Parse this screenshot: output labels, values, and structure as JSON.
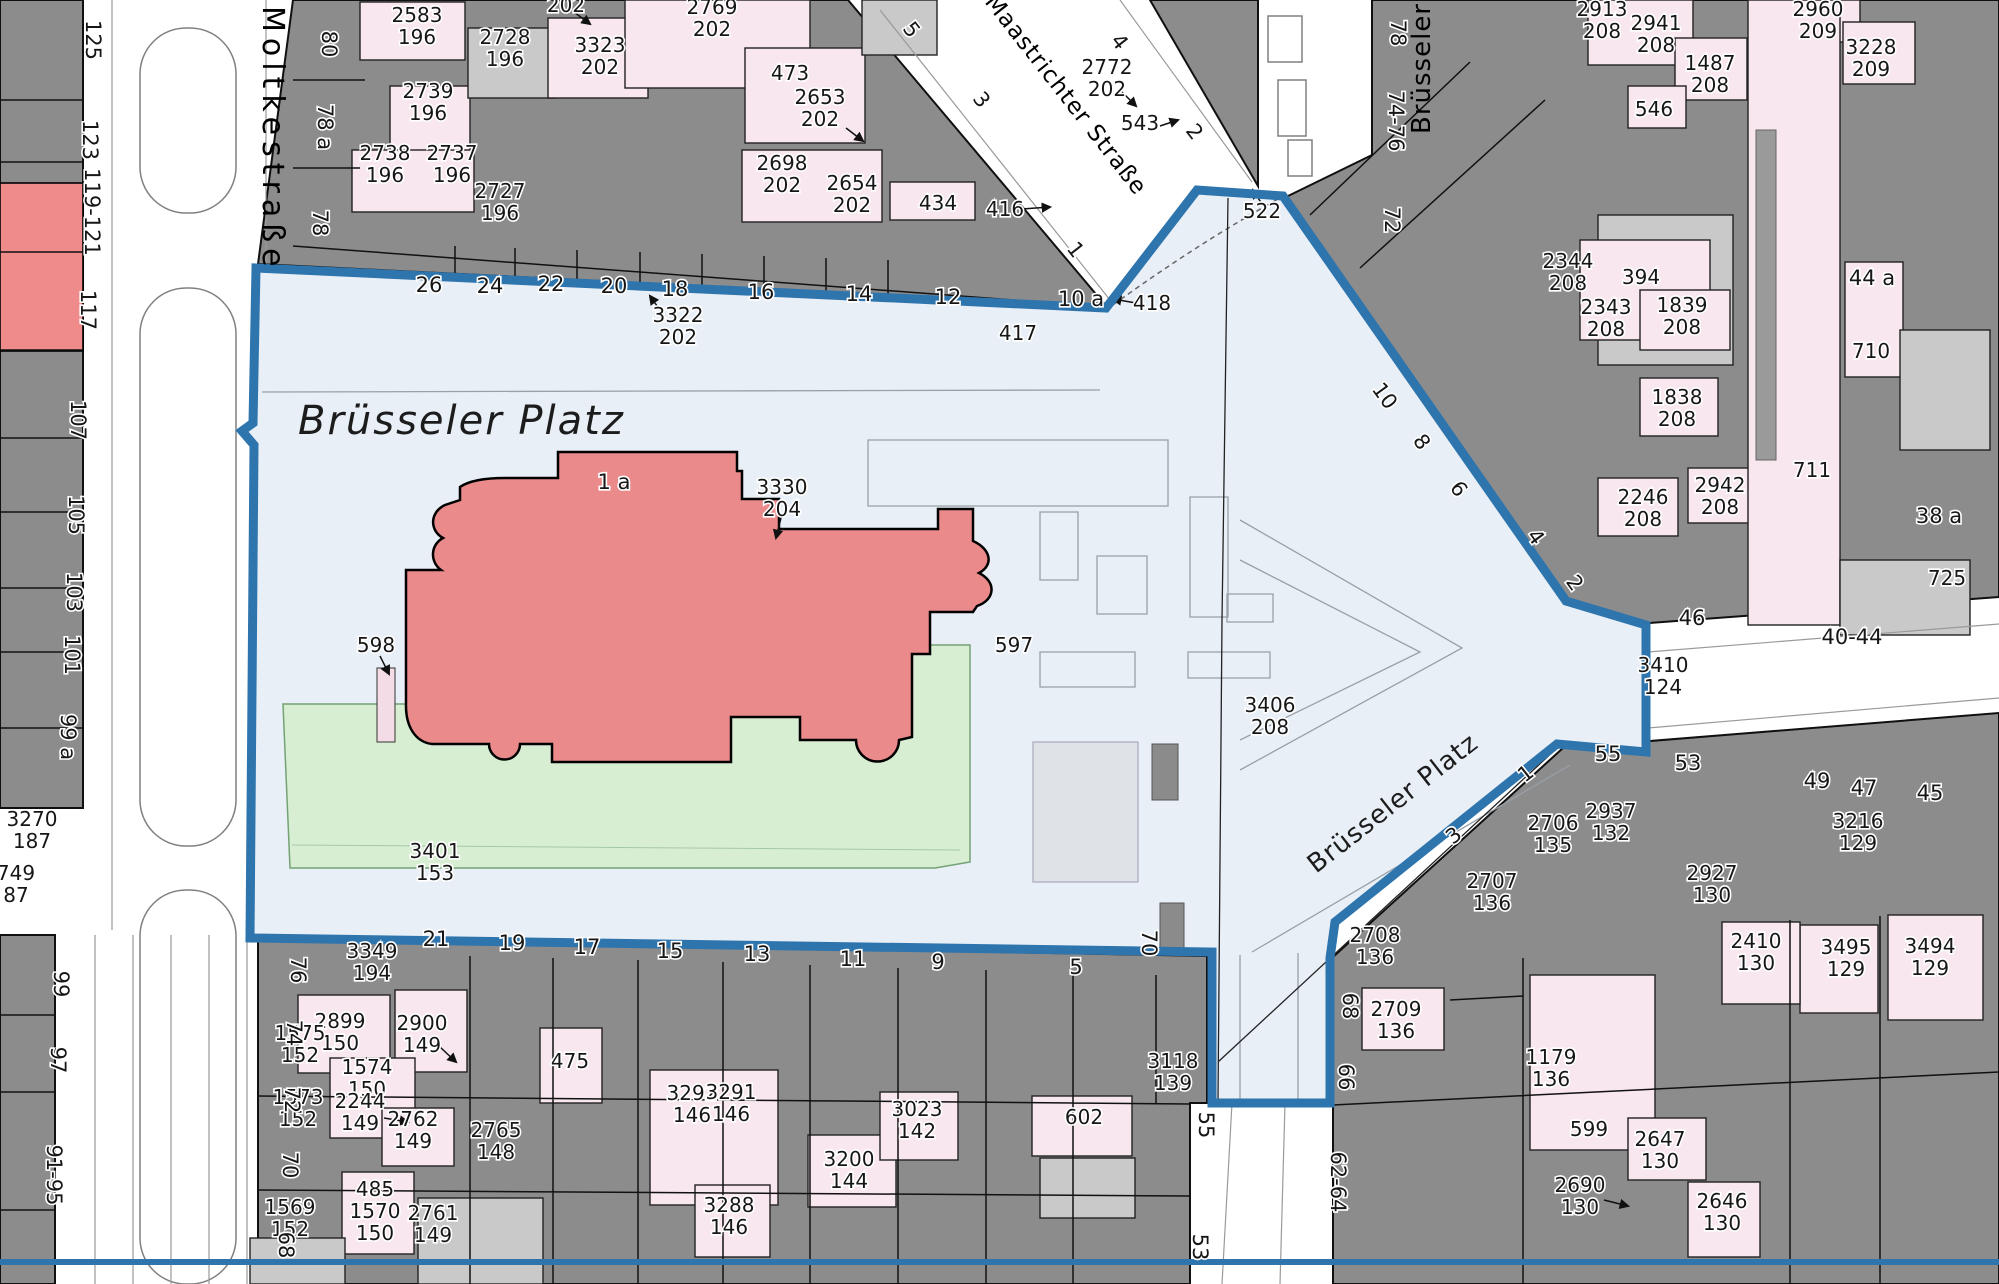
{
  "map": {
    "title": "Brüsseler Platz",
    "colors": {
      "boundary_blue": "#2e74ad",
      "plaza_fill": "#e9eff6",
      "building_gray": "#8c8c8c",
      "parcel_pink": "#f8e7ef",
      "courtyard_gray": "#c9c9c9",
      "red_parcel": "#f08b8b",
      "church_red": "#ea8a8a",
      "lawn_green": "#d8eed3"
    },
    "labels": [
      {
        "t": [
          "Moltkestraße"
        ],
        "x": 263,
        "y": 6,
        "r": 90,
        "c": "s2"
      },
      {
        "t": [
          "Maastrichter Straße"
        ],
        "x": 984,
        "y": 2,
        "r": 52,
        "c": "s3"
      },
      {
        "t": [
          "Brüsseler S"
        ],
        "x": 1430,
        "y": 134,
        "r": -90,
        "c": "s"
      },
      {
        "t": [
          "Brüsseler Platz"
        ],
        "x": 298,
        "y": 434,
        "c": "b"
      },
      {
        "t": [
          "Brüsseler Platz"
        ],
        "x": 1316,
        "y": 874,
        "r": -38,
        "c": "d"
      },
      {
        "t": [
          "1 a"
        ],
        "x": 614,
        "y": 489,
        "c": "h"
      },
      {
        "t": [
          "2583",
          "196"
        ],
        "x": 417,
        "y": 22,
        "c": "p"
      },
      {
        "t": [
          "2739",
          "196"
        ],
        "x": 428,
        "y": 98,
        "c": "p"
      },
      {
        "t": [
          "2738",
          "196"
        ],
        "x": 385,
        "y": 160,
        "c": "p"
      },
      {
        "t": [
          "2737",
          "196"
        ],
        "x": 452,
        "y": 160,
        "c": "p"
      },
      {
        "t": [
          "2727",
          "196"
        ],
        "x": 500,
        "y": 198,
        "c": "p"
      },
      {
        "t": [
          "2728",
          "196"
        ],
        "x": 505,
        "y": 44,
        "c": "p"
      },
      {
        "t": [
          "3323",
          "202"
        ],
        "x": 600,
        "y": 52,
        "c": "p"
      },
      {
        "t": [
          "2769",
          "202"
        ],
        "x": 712,
        "y": 14,
        "c": "p"
      },
      {
        "t": [
          "202"
        ],
        "x": 566,
        "y": 12,
        "c": "p"
      },
      {
        "t": [
          "473"
        ],
        "x": 790,
        "y": 80,
        "c": "p"
      },
      {
        "t": [
          "2653",
          "202"
        ],
        "x": 820,
        "y": 104,
        "c": "p"
      },
      {
        "t": [
          "2698",
          "202"
        ],
        "x": 782,
        "y": 170,
        "c": "p"
      },
      {
        "t": [
          "2654",
          "202"
        ],
        "x": 852,
        "y": 190,
        "c": "p"
      },
      {
        "t": [
          "434"
        ],
        "x": 938,
        "y": 210,
        "c": "p"
      },
      {
        "t": [
          "416"
        ],
        "x": 1005,
        "y": 216,
        "c": "p"
      },
      {
        "t": [
          "2772",
          "202"
        ],
        "x": 1107,
        "y": 74,
        "c": "p"
      },
      {
        "t": [
          "543"
        ],
        "x": 1140,
        "y": 130,
        "c": "p"
      },
      {
        "t": [
          "417"
        ],
        "x": 1018,
        "y": 340,
        "c": "p"
      },
      {
        "t": [
          "418"
        ],
        "x": 1152,
        "y": 310,
        "c": "p"
      },
      {
        "t": [
          "522"
        ],
        "x": 1262,
        "y": 218,
        "c": "p"
      },
      {
        "t": [
          "3322",
          "202"
        ],
        "x": 678,
        "y": 322,
        "c": "p"
      },
      {
        "t": [
          "3330",
          "204"
        ],
        "x": 782,
        "y": 494,
        "c": "p"
      },
      {
        "t": [
          "597"
        ],
        "x": 1014,
        "y": 652,
        "c": "p"
      },
      {
        "t": [
          "598"
        ],
        "x": 376,
        "y": 652,
        "c": "p"
      },
      {
        "t": [
          "3406",
          "208"
        ],
        "x": 1270,
        "y": 712,
        "c": "p"
      },
      {
        "t": [
          "3401",
          "153"
        ],
        "x": 435,
        "y": 858,
        "c": "p"
      },
      {
        "t": [
          "3270",
          "187"
        ],
        "x": 32,
        "y": 826,
        "c": "p"
      },
      {
        "t": [
          "749",
          "87"
        ],
        "x": 16,
        "y": 880,
        "c": "p"
      },
      {
        "t": [
          "3410",
          "124"
        ],
        "x": 1663,
        "y": 672,
        "c": "p"
      },
      {
        "t": [
          "2913",
          "208"
        ],
        "x": 1602,
        "y": 16,
        "c": "p"
      },
      {
        "t": [
          "2941",
          "208"
        ],
        "x": 1656,
        "y": 30,
        "c": "p"
      },
      {
        "t": [
          "1487",
          "208"
        ],
        "x": 1710,
        "y": 70,
        "c": "p"
      },
      {
        "t": [
          "2960",
          "209"
        ],
        "x": 1818,
        "y": 16,
        "c": "p"
      },
      {
        "t": [
          "3228",
          "209"
        ],
        "x": 1871,
        "y": 54,
        "c": "p"
      },
      {
        "t": [
          "546"
        ],
        "x": 1654,
        "y": 116,
        "c": "p"
      },
      {
        "t": [
          "2344",
          "208"
        ],
        "x": 1568,
        "y": 268,
        "c": "p"
      },
      {
        "t": [
          "394"
        ],
        "x": 1641,
        "y": 284,
        "c": "p"
      },
      {
        "t": [
          "2343",
          "208"
        ],
        "x": 1606,
        "y": 314,
        "c": "p"
      },
      {
        "t": [
          "1839",
          "208"
        ],
        "x": 1682,
        "y": 312,
        "c": "p"
      },
      {
        "t": [
          "1838",
          "208"
        ],
        "x": 1677,
        "y": 404,
        "c": "p"
      },
      {
        "t": [
          "2246",
          "208"
        ],
        "x": 1643,
        "y": 504,
        "c": "p"
      },
      {
        "t": [
          "2942",
          "208"
        ],
        "x": 1720,
        "y": 492,
        "c": "p"
      },
      {
        "t": [
          "710"
        ],
        "x": 1871,
        "y": 358,
        "c": "p"
      },
      {
        "t": [
          "711"
        ],
        "x": 1812,
        "y": 477,
        "c": "p"
      },
      {
        "t": [
          "725"
        ],
        "x": 1947,
        "y": 585,
        "c": "p"
      },
      {
        "t": [
          "2706",
          "135"
        ],
        "x": 1553,
        "y": 830,
        "c": "p"
      },
      {
        "t": [
          "2707",
          "136"
        ],
        "x": 1492,
        "y": 888,
        "c": "p"
      },
      {
        "t": [
          "2708",
          "136"
        ],
        "x": 1375,
        "y": 942,
        "c": "p"
      },
      {
        "t": [
          "2709",
          "136"
        ],
        "x": 1396,
        "y": 1016,
        "c": "p"
      },
      {
        "t": [
          "2937",
          "132"
        ],
        "x": 1611,
        "y": 818,
        "c": "p"
      },
      {
        "t": [
          "3216",
          "129"
        ],
        "x": 1858,
        "y": 828,
        "c": "p"
      },
      {
        "t": [
          "2927",
          "130"
        ],
        "x": 1712,
        "y": 880,
        "c": "p"
      },
      {
        "t": [
          "2410",
          "130"
        ],
        "x": 1756,
        "y": 948,
        "c": "p"
      },
      {
        "t": [
          "3495",
          "129"
        ],
        "x": 1846,
        "y": 954,
        "c": "p"
      },
      {
        "t": [
          "3494",
          "129"
        ],
        "x": 1930,
        "y": 953,
        "c": "p"
      },
      {
        "t": [
          "1179",
          "136"
        ],
        "x": 1551,
        "y": 1064,
        "c": "p"
      },
      {
        "t": [
          "599"
        ],
        "x": 1589,
        "y": 1136,
        "c": "p"
      },
      {
        "t": [
          "2647",
          "130"
        ],
        "x": 1660,
        "y": 1146,
        "c": "p"
      },
      {
        "t": [
          "2690",
          "130"
        ],
        "x": 1580,
        "y": 1192,
        "c": "p"
      },
      {
        "t": [
          "2646",
          "130"
        ],
        "x": 1722,
        "y": 1208,
        "c": "p"
      },
      {
        "t": [
          "3349",
          "194"
        ],
        "x": 372,
        "y": 958,
        "c": "p"
      },
      {
        "t": [
          "2899",
          "150"
        ],
        "x": 340,
        "y": 1028,
        "c": "p"
      },
      {
        "t": [
          "1575",
          "152"
        ],
        "x": 300,
        "y": 1040,
        "c": "p"
      },
      {
        "t": [
          "2900",
          "149"
        ],
        "x": 422,
        "y": 1030,
        "c": "p"
      },
      {
        "t": [
          "1574",
          "150"
        ],
        "x": 367,
        "y": 1074,
        "c": "p"
      },
      {
        "t": [
          "1573",
          "152"
        ],
        "x": 298,
        "y": 1104,
        "c": "p"
      },
      {
        "t": [
          "2244",
          "149"
        ],
        "x": 360,
        "y": 1108,
        "c": "p"
      },
      {
        "t": [
          "2762",
          "149"
        ],
        "x": 413,
        "y": 1126,
        "c": "p"
      },
      {
        "t": [
          "485"
        ],
        "x": 375,
        "y": 1196,
        "c": "p"
      },
      {
        "t": [
          "1570",
          "150"
        ],
        "x": 375,
        "y": 1218,
        "c": "p"
      },
      {
        "t": [
          "1569",
          "152"
        ],
        "x": 290,
        "y": 1214,
        "c": "p"
      },
      {
        "t": [
          "2761",
          "149"
        ],
        "x": 433,
        "y": 1220,
        "c": "p"
      },
      {
        "t": [
          "2765",
          "148"
        ],
        "x": 496,
        "y": 1137,
        "c": "p"
      },
      {
        "t": [
          "475"
        ],
        "x": 570,
        "y": 1068,
        "c": "p"
      },
      {
        "t": [
          "3292",
          "146"
        ],
        "x": 692,
        "y": 1100,
        "c": "p"
      },
      {
        "t": [
          "3291",
          "146"
        ],
        "x": 731,
        "y": 1099,
        "c": "p"
      },
      {
        "t": [
          "3288",
          "146"
        ],
        "x": 729,
        "y": 1212,
        "c": "p"
      },
      {
        "t": [
          "3200",
          "144"
        ],
        "x": 849,
        "y": 1166,
        "c": "p"
      },
      {
        "t": [
          "3023",
          "142"
        ],
        "x": 917,
        "y": 1116,
        "c": "p"
      },
      {
        "t": [
          "602"
        ],
        "x": 1084,
        "y": 1124,
        "c": "p"
      },
      {
        "t": [
          "3118",
          "139"
        ],
        "x": 1173,
        "y": 1068,
        "c": "p"
      },
      {
        "t": [
          "125"
        ],
        "x": 86,
        "y": 40,
        "r": 90,
        "c": "h"
      },
      {
        "t": [
          "123"
        ],
        "x": 83,
        "y": 140,
        "r": 90,
        "c": "h"
      },
      {
        "t": [
          "119-121"
        ],
        "x": 85,
        "y": 212,
        "r": 90,
        "c": "h"
      },
      {
        "t": [
          "117"
        ],
        "x": 81,
        "y": 310,
        "r": 90,
        "c": "h"
      },
      {
        "t": [
          "107"
        ],
        "x": 71,
        "y": 420,
        "r": 90,
        "c": "h"
      },
      {
        "t": [
          "105"
        ],
        "x": 69,
        "y": 515,
        "r": 90,
        "c": "h"
      },
      {
        "t": [
          "103"
        ],
        "x": 67,
        "y": 592,
        "r": 90,
        "c": "h"
      },
      {
        "t": [
          "101"
        ],
        "x": 65,
        "y": 655,
        "r": 90,
        "c": "h"
      },
      {
        "t": [
          "99 a"
        ],
        "x": 61,
        "y": 737,
        "r": 90,
        "c": "h"
      },
      {
        "t": [
          "99"
        ],
        "x": 54,
        "y": 984,
        "r": 90,
        "c": "h"
      },
      {
        "t": [
          "97"
        ],
        "x": 51,
        "y": 1060,
        "r": 90,
        "c": "h"
      },
      {
        "t": [
          "91-95"
        ],
        "x": 47,
        "y": 1175,
        "r": 90,
        "c": "h"
      },
      {
        "t": [
          "80"
        ],
        "x": 322,
        "y": 44,
        "r": 90,
        "c": "h"
      },
      {
        "t": [
          "78 a"
        ],
        "x": 318,
        "y": 127,
        "r": 90,
        "c": "h"
      },
      {
        "t": [
          "78"
        ],
        "x": 313,
        "y": 223,
        "r": 90,
        "c": "h"
      },
      {
        "t": [
          "76"
        ],
        "x": 291,
        "y": 970,
        "r": 90,
        "c": "h"
      },
      {
        "t": [
          "74"
        ],
        "x": 287,
        "y": 1033,
        "r": 90,
        "c": "h"
      },
      {
        "t": [
          "72"
        ],
        "x": 285,
        "y": 1100,
        "r": 90,
        "c": "h"
      },
      {
        "t": [
          "70"
        ],
        "x": 283,
        "y": 1165,
        "r": 90,
        "c": "h"
      },
      {
        "t": [
          "68"
        ],
        "x": 279,
        "y": 1245,
        "r": 90,
        "c": "h"
      },
      {
        "t": [
          "26"
        ],
        "x": 429,
        "y": 292,
        "c": "h"
      },
      {
        "t": [
          "24"
        ],
        "x": 490,
        "y": 293,
        "c": "h"
      },
      {
        "t": [
          "22"
        ],
        "x": 551,
        "y": 291,
        "c": "h"
      },
      {
        "t": [
          "20"
        ],
        "x": 614,
        "y": 293,
        "c": "h"
      },
      {
        "t": [
          "18"
        ],
        "x": 675,
        "y": 296,
        "c": "h"
      },
      {
        "t": [
          "16"
        ],
        "x": 761,
        "y": 299,
        "c": "h"
      },
      {
        "t": [
          "14"
        ],
        "x": 859,
        "y": 301,
        "c": "h"
      },
      {
        "t": [
          "12"
        ],
        "x": 948,
        "y": 304,
        "c": "h"
      },
      {
        "t": [
          "10 a"
        ],
        "x": 1081,
        "y": 306,
        "c": "h"
      },
      {
        "t": [
          "5"
        ],
        "x": 906,
        "y": 34,
        "r": 52,
        "c": "h"
      },
      {
        "t": [
          "3"
        ],
        "x": 976,
        "y": 104,
        "r": 52,
        "c": "h"
      },
      {
        "t": [
          "1"
        ],
        "x": 1070,
        "y": 254,
        "r": 52,
        "c": "h"
      },
      {
        "t": [
          "4"
        ],
        "x": 1114,
        "y": 46,
        "r": 52,
        "c": "h"
      },
      {
        "t": [
          "2"
        ],
        "x": 1189,
        "y": 136,
        "r": 52,
        "c": "h"
      },
      {
        "t": [
          "10"
        ],
        "x": 1379,
        "y": 400,
        "r": 54,
        "c": "h"
      },
      {
        "t": [
          "8"
        ],
        "x": 1416,
        "y": 446,
        "r": 54,
        "c": "h"
      },
      {
        "t": [
          "6"
        ],
        "x": 1453,
        "y": 493,
        "r": 54,
        "c": "h"
      },
      {
        "t": [
          "4"
        ],
        "x": 1530,
        "y": 541,
        "r": 54,
        "c": "h"
      },
      {
        "t": [
          "2"
        ],
        "x": 1569,
        "y": 587,
        "r": 54,
        "c": "h"
      },
      {
        "t": [
          "78"
        ],
        "x": 1391,
        "y": 33,
        "r": 90,
        "c": "h"
      },
      {
        "t": [
          "74-76"
        ],
        "x": 1389,
        "y": 121,
        "r": 90,
        "c": "h"
      },
      {
        "t": [
          "72"
        ],
        "x": 1385,
        "y": 220,
        "r": 90,
        "c": "h"
      },
      {
        "t": [
          "21"
        ],
        "x": 436,
        "y": 946,
        "c": "h"
      },
      {
        "t": [
          "19"
        ],
        "x": 512,
        "y": 950,
        "c": "h"
      },
      {
        "t": [
          "17"
        ],
        "x": 587,
        "y": 954,
        "c": "h"
      },
      {
        "t": [
          "15"
        ],
        "x": 670,
        "y": 958,
        "c": "h"
      },
      {
        "t": [
          "13"
        ],
        "x": 757,
        "y": 961,
        "c": "h"
      },
      {
        "t": [
          "11"
        ],
        "x": 853,
        "y": 966,
        "c": "h"
      },
      {
        "t": [
          "9"
        ],
        "x": 938,
        "y": 969,
        "c": "h"
      },
      {
        "t": [
          "5"
        ],
        "x": 1076,
        "y": 974,
        "c": "h"
      },
      {
        "t": [
          "70"
        ],
        "x": 1142,
        "y": 943,
        "r": 90,
        "c": "h"
      },
      {
        "t": [
          "55"
        ],
        "x": 1199,
        "y": 1125,
        "r": 90,
        "c": "h"
      },
      {
        "t": [
          "53"
        ],
        "x": 1193,
        "y": 1247,
        "r": 90,
        "c": "h"
      },
      {
        "t": [
          "68"
        ],
        "x": 1343,
        "y": 1006,
        "r": 90,
        "c": "h"
      },
      {
        "t": [
          "66"
        ],
        "x": 1339,
        "y": 1077,
        "r": 90,
        "c": "h"
      },
      {
        "t": [
          "62-64"
        ],
        "x": 1331,
        "y": 1182,
        "r": 90,
        "c": "h"
      },
      {
        "t": [
          "55"
        ],
        "x": 1608,
        "y": 761,
        "c": "h"
      },
      {
        "t": [
          "53"
        ],
        "x": 1688,
        "y": 770,
        "c": "h"
      },
      {
        "t": [
          "49"
        ],
        "x": 1817,
        "y": 788,
        "c": "h"
      },
      {
        "t": [
          "47"
        ],
        "x": 1864,
        "y": 795,
        "c": "h"
      },
      {
        "t": [
          "45"
        ],
        "x": 1930,
        "y": 800,
        "c": "h"
      },
      {
        "t": [
          "46"
        ],
        "x": 1692,
        "y": 625,
        "c": "h"
      },
      {
        "t": [
          "40-44"
        ],
        "x": 1852,
        "y": 644,
        "c": "h"
      },
      {
        "t": [
          "44 a"
        ],
        "x": 1872,
        "y": 285,
        "c": "h"
      },
      {
        "t": [
          "38 a"
        ],
        "x": 1939,
        "y": 523,
        "c": "h"
      },
      {
        "t": [
          "1"
        ],
        "x": 1530,
        "y": 779,
        "r": -38,
        "c": "h"
      },
      {
        "t": [
          "3"
        ],
        "x": 1458,
        "y": 841,
        "r": -38,
        "c": "h"
      }
    ]
  }
}
